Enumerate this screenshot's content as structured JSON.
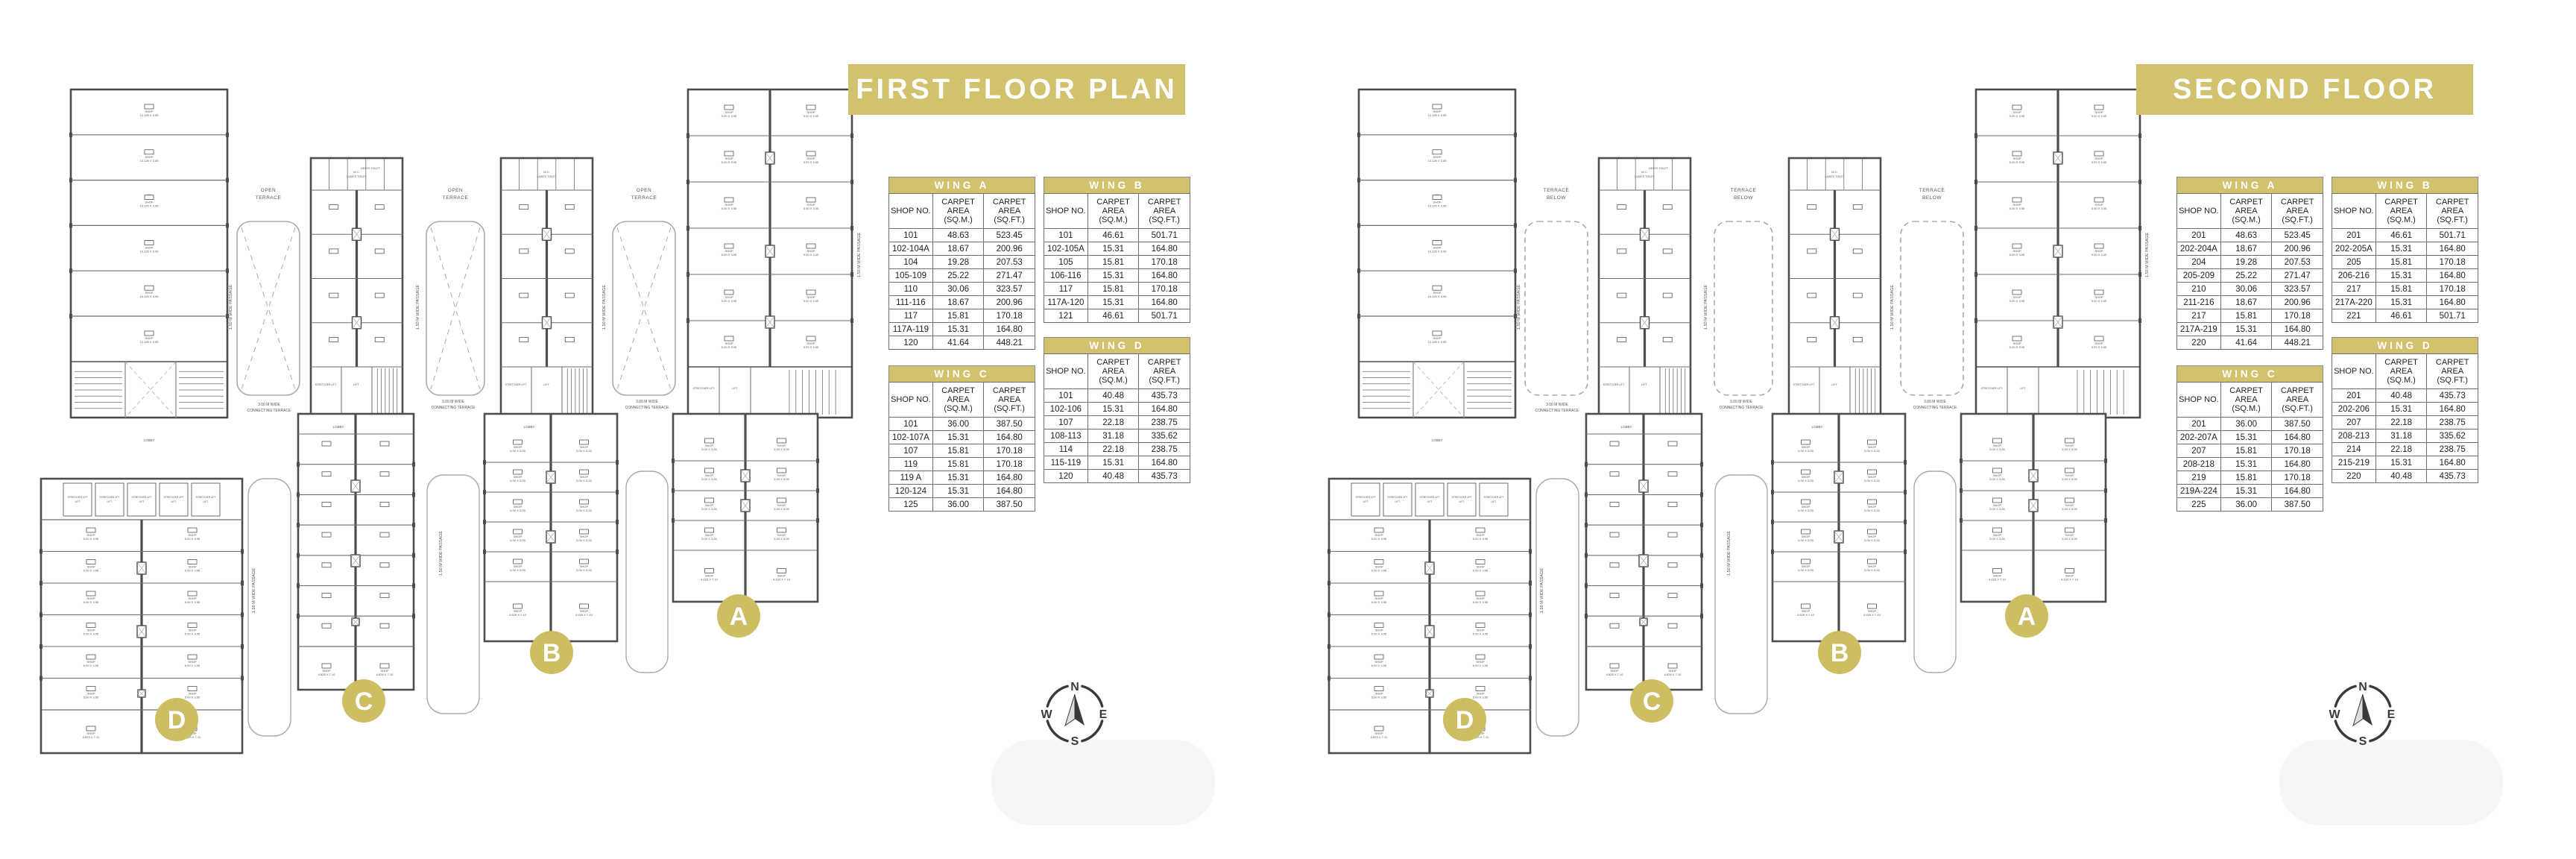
{
  "colors": {
    "gold": "#d2c26d",
    "gold_circle": "#cdbd63",
    "wall": "#4d4d4d",
    "inner_line": "#6e6e6e",
    "light_line": "#aaaaaa",
    "tiny_text": "#555555",
    "compass_ink": "#3a3a3a",
    "watermark": "#f6f6f6"
  },
  "compass": {
    "north": "N",
    "east": "E",
    "south": "S",
    "west": "W"
  },
  "table_headers": {
    "shop": "SHOP NO.",
    "sqm": "CARPET AREA (SQ.M.)",
    "sqft": "CARPET AREA (SQ.FT.)"
  },
  "plan_labels": {
    "passage": "1.50 M WIDE PASSAGE",
    "connecting_1": "3.00 M WIDE",
    "connecting_2": "CONNECTING TERRACE",
    "lobby": "LOBBY",
    "shop": "SHOP",
    "wc": "W.C.",
    "lift": "LIFT",
    "stretcher_lift": "STRETCHER LIFT",
    "service_lift": "SERVICE LIFT",
    "ladies_toilet": "LADIES TOILET",
    "gents_toilet": "GENTS TOILET",
    "dims_large": "10.125 X 3.05",
    "dims_std": "5.00 X 3.05",
    "dims_wide": "4.625 X 7.10"
  },
  "panels": [
    {
      "title": "FIRST FLOOR PLAN",
      "void_label": "OPEN TERRACE",
      "void_style": "solid-x",
      "wing_markers": [
        "D",
        "C",
        "B",
        "A"
      ],
      "tables": [
        {
          "wing": "WING A",
          "rows": [
            [
              "101",
              "48.63",
              "523.45"
            ],
            [
              "102-104A",
              "18.67",
              "200.96"
            ],
            [
              "104",
              "19.28",
              "207.53"
            ],
            [
              "105-109",
              "25.22",
              "271.47"
            ],
            [
              "110",
              "30.06",
              "323.57"
            ],
            [
              "111-116",
              "18.67",
              "200.96"
            ],
            [
              "117",
              "15.81",
              "170.18"
            ],
            [
              "117A-119",
              "15.31",
              "164.80"
            ],
            [
              "120",
              "41.64",
              "448.21"
            ]
          ]
        },
        {
          "wing": "WING B",
          "rows": [
            [
              "101",
              "46.61",
              "501.71"
            ],
            [
              "102-105A",
              "15.31",
              "164.80"
            ],
            [
              "105",
              "15.81",
              "170.18"
            ],
            [
              "106-116",
              "15.31",
              "164.80"
            ],
            [
              "117",
              "15.81",
              "170.18"
            ],
            [
              "117A-120",
              "15.31",
              "164.80"
            ],
            [
              "121",
              "46.61",
              "501.71"
            ]
          ]
        },
        {
          "wing": "WING C",
          "rows": [
            [
              "101",
              "36.00",
              "387.50"
            ],
            [
              "102-107A",
              "15.31",
              "164.80"
            ],
            [
              "107",
              "15.81",
              "170.18"
            ],
            [
              "119",
              "15.81",
              "170.18"
            ],
            [
              "119 A",
              "15.31",
              "164.80"
            ],
            [
              "120-124",
              "15.31",
              "164.80"
            ],
            [
              "125",
              "36.00",
              "387.50"
            ]
          ]
        },
        {
          "wing": "WING D",
          "rows": [
            [
              "101",
              "40.48",
              "435.73"
            ],
            [
              "102-106",
              "15.31",
              "164.80"
            ],
            [
              "107",
              "22.18",
              "238.75"
            ],
            [
              "108-113",
              "31.18",
              "335.62"
            ],
            [
              "114",
              "22.18",
              "238.75"
            ],
            [
              "115-119",
              "15.31",
              "164.80"
            ],
            [
              "120",
              "40.48",
              "435.73"
            ]
          ]
        }
      ]
    },
    {
      "title": "SECOND FLOOR PLAN",
      "void_label": "TERRACE BELOW",
      "void_style": "dashed",
      "wing_markers": [
        "D",
        "C",
        "B",
        "A"
      ],
      "tables": [
        {
          "wing": "WING A",
          "rows": [
            [
              "201",
              "48.63",
              "523.45"
            ],
            [
              "202-204A",
              "18.67",
              "200.96"
            ],
            [
              "204",
              "19.28",
              "207.53"
            ],
            [
              "205-209",
              "25.22",
              "271.47"
            ],
            [
              "210",
              "30.06",
              "323.57"
            ],
            [
              "211-216",
              "18.67",
              "200.96"
            ],
            [
              "217",
              "15.81",
              "170.18"
            ],
            [
              "217A-219",
              "15.31",
              "164.80"
            ],
            [
              "220",
              "41.64",
              "448.21"
            ]
          ]
        },
        {
          "wing": "WING B",
          "rows": [
            [
              "201",
              "46.61",
              "501.71"
            ],
            [
              "202-205A",
              "15.31",
              "164.80"
            ],
            [
              "205",
              "15.81",
              "170.18"
            ],
            [
              "206-216",
              "15.31",
              "164.80"
            ],
            [
              "217",
              "15.81",
              "170.18"
            ],
            [
              "217A-220",
              "15.31",
              "164.80"
            ],
            [
              "221",
              "46.61",
              "501.71"
            ]
          ]
        },
        {
          "wing": "WING C",
          "rows": [
            [
              "201",
              "36.00",
              "387.50"
            ],
            [
              "202-207A",
              "15.31",
              "164.80"
            ],
            [
              "207",
              "15.81",
              "170.18"
            ],
            [
              "208-218",
              "15.31",
              "164.80"
            ],
            [
              "219",
              "15.81",
              "170.18"
            ],
            [
              "219A-224",
              "15.31",
              "164.80"
            ],
            [
              "225",
              "36.00",
              "387.50"
            ]
          ]
        },
        {
          "wing": "WING D",
          "rows": [
            [
              "201",
              "40.48",
              "435.73"
            ],
            [
              "202-206",
              "15.31",
              "164.80"
            ],
            [
              "207",
              "22.18",
              "238.75"
            ],
            [
              "208-213",
              "31.18",
              "335.62"
            ],
            [
              "214",
              "22.18",
              "238.75"
            ],
            [
              "215-219",
              "15.31",
              "164.80"
            ],
            [
              "220",
              "40.48",
              "435.73"
            ]
          ]
        }
      ]
    }
  ]
}
